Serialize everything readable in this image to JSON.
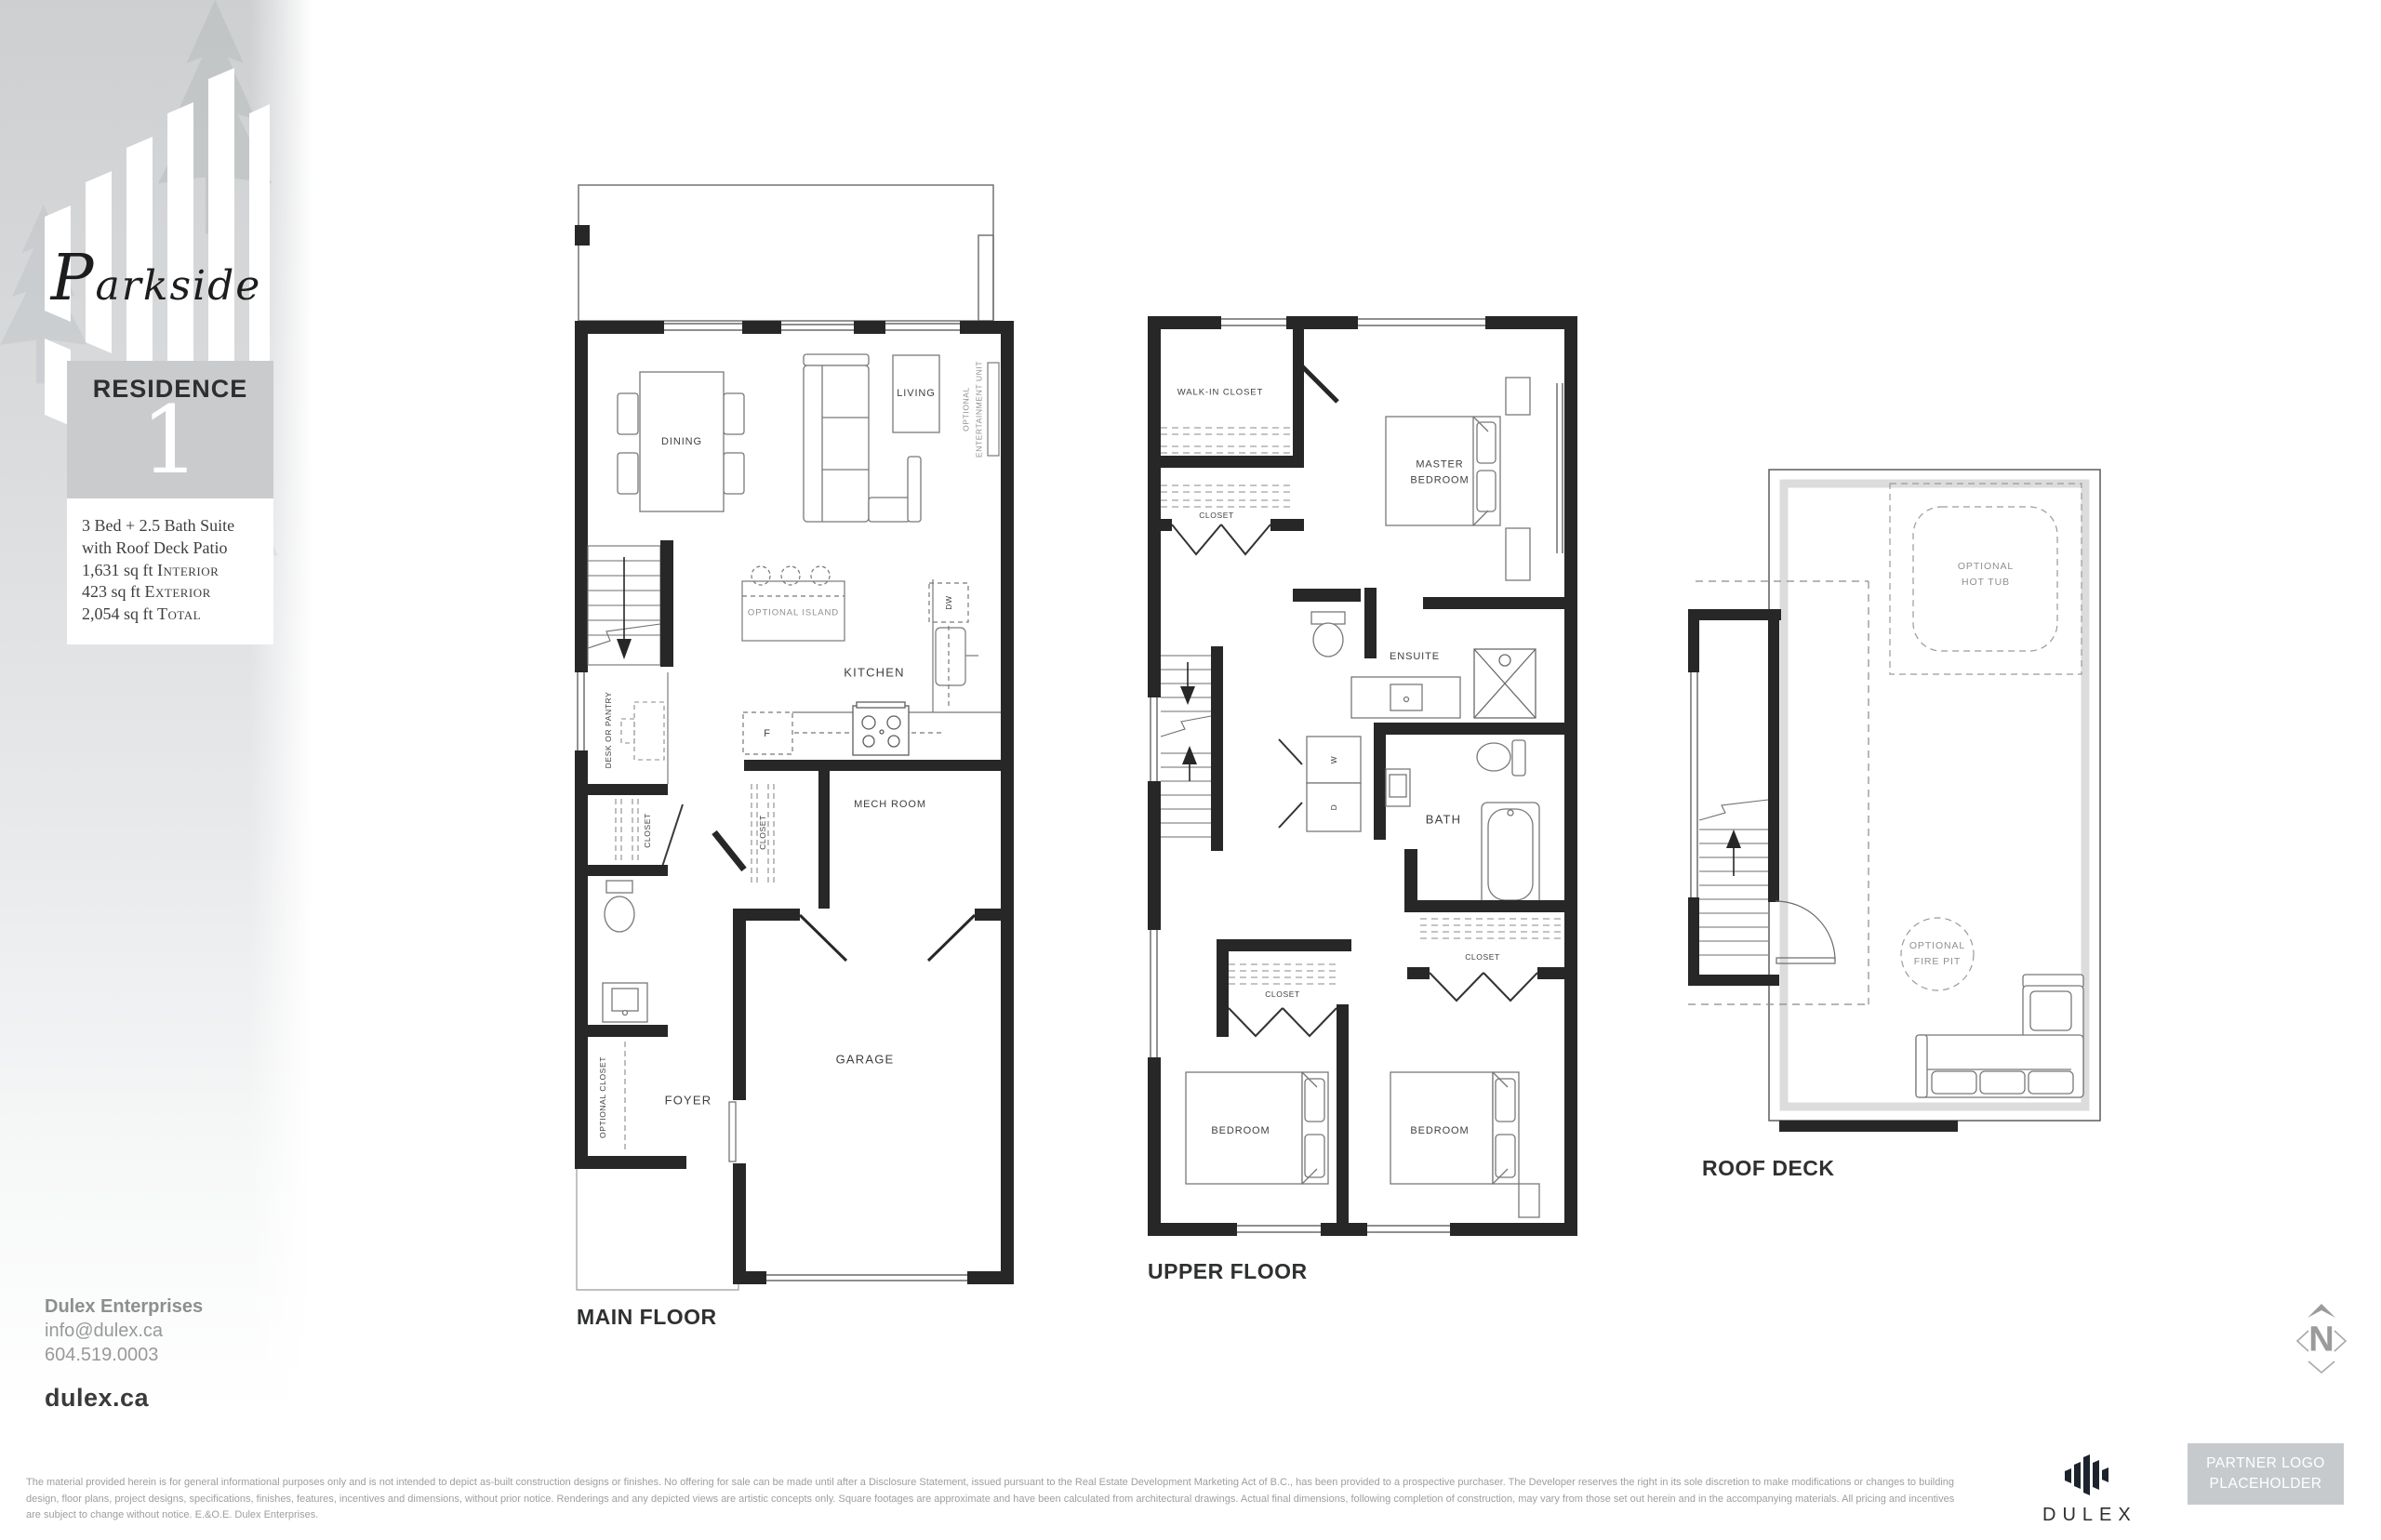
{
  "branding": {
    "project_name": "Parkside",
    "residence_label": "RESIDENCE",
    "residence_number": "1",
    "spec_line1": "3 Bed + 2.5 Bath Suite",
    "spec_line2": "with Roof Deck Patio",
    "areas": [
      {
        "value": "1,631 sq ft",
        "label": "Interior"
      },
      {
        "value": "423 sq ft",
        "label": "Exterior"
      },
      {
        "value": "2,054 sq ft",
        "label": "Total"
      }
    ]
  },
  "contact": {
    "company": "Dulex Enterprises",
    "email": "info@dulex.ca",
    "phone": "604.519.0003",
    "website": "dulex.ca"
  },
  "plans": {
    "main": {
      "title": "MAIN FLOOR",
      "labels": {
        "dining": "DINING",
        "living": "LIVING",
        "optional_ent_1": "OPTIONAL",
        "optional_ent_2": "ENTERTAINMENT UNIT",
        "optional_island": "OPTIONAL ISLAND",
        "kitchen": "KITCHEN",
        "dw": "DW",
        "fridge": "F",
        "desk_or_pantry": "DESK OR PANTRY",
        "closet_hall": "CLOSET",
        "closet_mid": "CLOSET",
        "mech_room": "MECH ROOM",
        "optional_closet": "OPTIONAL CLOSET",
        "foyer": "FOYER",
        "garage": "GARAGE"
      }
    },
    "upper": {
      "title": "UPPER FLOOR",
      "labels": {
        "walk_in_closet": "WALK-IN CLOSET",
        "closet_top": "CLOSET",
        "master_1": "MASTER",
        "master_2": "BEDROOM",
        "ensuite": "ENSUITE",
        "washer": "W",
        "dryer": "D",
        "bath": "BATH",
        "closet_left": "CLOSET",
        "closet_right": "CLOSET",
        "bedroom_left": "BEDROOM",
        "bedroom_right": "BEDROOM"
      }
    },
    "roof": {
      "title": "ROOF DECK",
      "labels": {
        "hot_tub_1": "OPTIONAL",
        "hot_tub_2": "HOT TUB",
        "fire_pit_1": "OPTIONAL",
        "fire_pit_2": "FIRE PIT"
      }
    }
  },
  "compass": {
    "north": "N"
  },
  "footer": {
    "disclaimer_lines": [
      "The material provided herein is for general informational purposes only and is not intended to depict as-built construction designs or finishes. No offering for sale can be made until after a Disclosure Statement, issued pursuant to the Real Estate Development Marketing Act of B.C., has been provided to a prospective purchaser. The Developer reserves the right in its sole discretion to make modifications or changes to building",
      "design, floor plans, project designs, specifications, finishes, features, incentives and dimensions, without prior notice. Renderings and any depicted views are artistic concepts only. Square footages are approximate and have been calculated from architectural drawings. Actual final dimensions, following completion of construction, may vary from those set out herein and in the accompanying materials. All pricing and incentives",
      "are subject to change without notice. E.&O.E. Dulex Enterprises."
    ],
    "dulex_wordmark": "DULEX",
    "partner_line1": "PARTNER LOGO",
    "partner_line2": "PLACEHOLDER"
  }
}
